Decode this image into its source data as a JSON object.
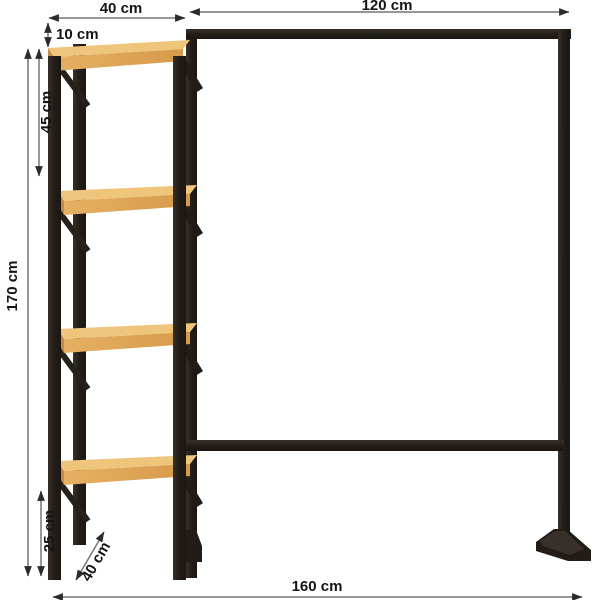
{
  "dimensions": {
    "shelf_width": {
      "label": "40 cm",
      "meaning": "shelf section width"
    },
    "rail_width": {
      "label": "120 cm",
      "meaning": "hanging rail section width"
    },
    "top_offset": {
      "label": "10 cm",
      "meaning": "gap between frame top and top shelf"
    },
    "shelf_spacing": {
      "label": "45 cm",
      "meaning": "spacing between shelves"
    },
    "total_height": {
      "label": "170 cm",
      "meaning": "overall height"
    },
    "bottom_clearance": {
      "label": "25 cm",
      "meaning": "bottom shelf height from floor"
    },
    "depth": {
      "label": "40 cm",
      "meaning": "unit depth"
    },
    "total_width": {
      "label": "160 cm",
      "meaning": "overall width"
    }
  },
  "colors": {
    "background": "#ffffff",
    "frame": "#241e19",
    "frame_highlight": "#38302a",
    "wood_top": "#efc47b",
    "wood_front": "#dfa557",
    "wood_side": "#c28c45",
    "dimension_line": "#757575",
    "arrowhead": "#2b2b2b",
    "label_text": "#141414"
  }
}
